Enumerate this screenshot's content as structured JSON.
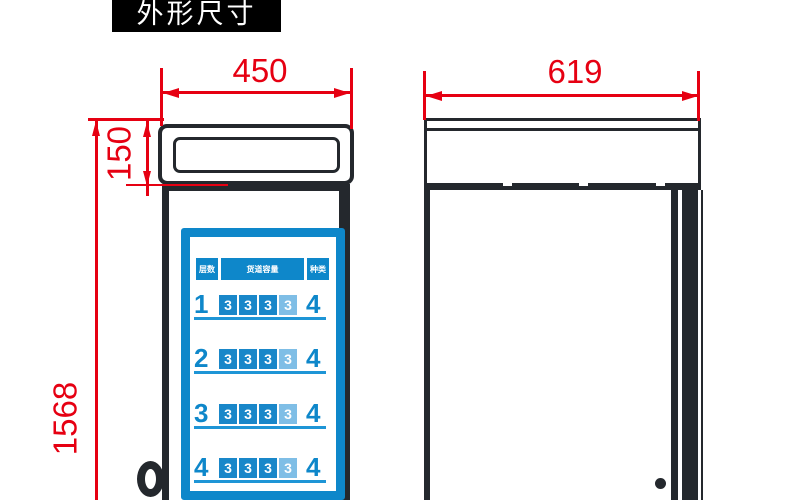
{
  "title": "外形尺寸",
  "dimensions": {
    "front_width": "450",
    "side_depth": "619",
    "header_height": "150",
    "total_height": "1568"
  },
  "panel": {
    "col_layers": "层数",
    "col_capacity": "货道容量",
    "col_types": "种类",
    "rows": [
      {
        "layer": "1",
        "cells": [
          "3",
          "3",
          "3",
          "3"
        ],
        "types": "4"
      },
      {
        "layer": "2",
        "cells": [
          "3",
          "3",
          "3",
          "3"
        ],
        "types": "4"
      },
      {
        "layer": "3",
        "cells": [
          "3",
          "3",
          "3",
          "3"
        ],
        "types": "4"
      },
      {
        "layer": "4",
        "cells": [
          "3",
          "3",
          "3",
          "3"
        ],
        "types": "4"
      }
    ]
  },
  "colors": {
    "accent_red": "#e60012",
    "line_dark": "#24282d",
    "blue": "#0e87ca",
    "blue_light": "#7fbee6"
  }
}
